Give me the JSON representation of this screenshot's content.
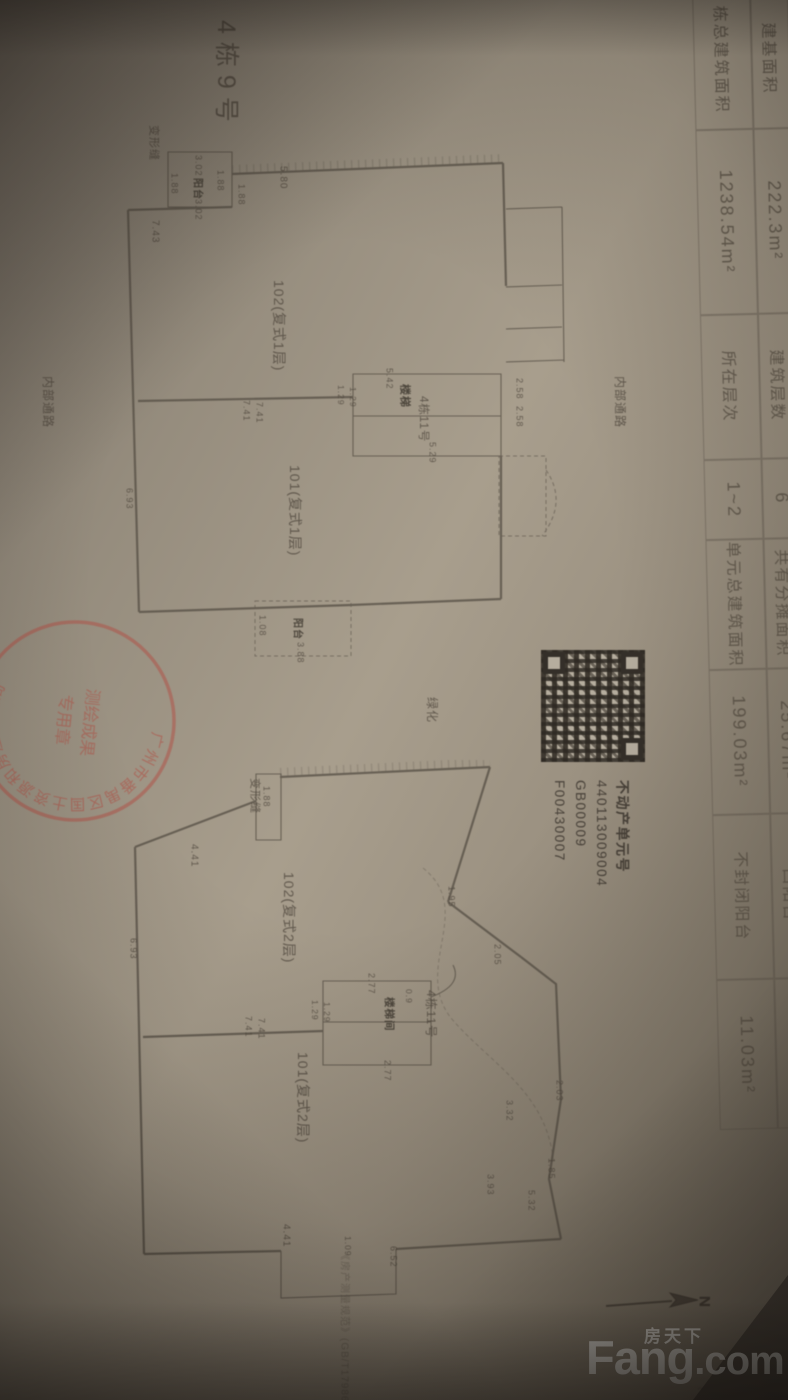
{
  "sheet_title": "4栋9号",
  "table": {
    "r1": [
      {
        "l": "建基面积",
        "v": "222.3m²"
      },
      {
        "l": "建筑层数",
        "v": "6"
      },
      {
        "l": "共有分摊面积",
        "v": "25.67m²"
      },
      {
        "l": "凹阳台",
        "v": "0.00m²"
      }
    ],
    "r2": [
      {
        "l": "栋总建筑面积",
        "v": "1238.54m²"
      },
      {
        "l": "所在层次",
        "v": "1~2"
      },
      {
        "l": "单元总建筑面积",
        "v": "199.03m²"
      },
      {
        "l": "不封闭阳台",
        "v": "11.03m²"
      }
    ]
  },
  "qr": {
    "title": "不动产单元号",
    "lines": [
      "440113009004",
      "GB00009",
      "F00430007"
    ]
  },
  "stamp": {
    "arc_text": "广州市番禺区国土资源和房屋管理局",
    "center_line1": "测绘成果",
    "center_line2": "专用章",
    "color": "#b5463a"
  },
  "north": {
    "label": "N"
  },
  "watermark": {
    "cn": "房天下",
    "en_bold": "Fang",
    "en_rest": ".com"
  },
  "overlay_labels": [
    {
      "t": "4栋9号",
      "x": 211,
      "y": 20,
      "fs": 25,
      "ls": 8,
      "n": "sheet-title-label"
    },
    {
      "t": "变形缝",
      "x": 147,
      "y": 125,
      "fs": 11,
      "n": "expansion-joint-label"
    },
    {
      "t": "内部通路",
      "x": 612,
      "y": 376,
      "fs": 12,
      "n": "internal-road-label"
    },
    {
      "t": "内部通路",
      "x": 40,
      "y": 376,
      "fs": 12,
      "n": "internal-road-label"
    },
    {
      "t": "绿化",
      "x": 424,
      "y": 697,
      "fs": 12,
      "n": "greenery-label"
    },
    {
      "t": "变形缝",
      "x": 248,
      "y": 778,
      "fs": 11,
      "n": "expansion-joint-label"
    },
    {
      "t": "《房产测量规范》(GB/T17986.1-20",
      "x": 338,
      "y": 1250,
      "fs": 10,
      "op": 0.55,
      "n": "note-text"
    },
    {
      "t": "2006.1",
      "x": 697,
      "y": 1386,
      "fs": 11,
      "op": 0.6,
      "hz": 1,
      "n": "date-text"
    },
    {
      "t": "3.02",
      "x": 193,
      "y": 155
    },
    {
      "t": "阳台",
      "x": 191,
      "y": 178,
      "fs": 10,
      "b": 1,
      "n": "room-label"
    },
    {
      "t": "3.02",
      "x": 193,
      "y": 199
    },
    {
      "t": "1.88",
      "x": 169,
      "y": 173
    },
    {
      "t": "1.88",
      "x": 215,
      "y": 170
    },
    {
      "t": "1.88",
      "x": 236,
      "y": 184
    },
    {
      "t": "5.80",
      "x": 277,
      "y": 166,
      "fs": 10
    },
    {
      "t": "7.43",
      "x": 149,
      "y": 220,
      "fs": 10
    },
    {
      "t": "102(复式1层)",
      "x": 271,
      "y": 280,
      "fs": 14,
      "n": "room-label"
    },
    {
      "t": "101(复式1层)",
      "x": 287,
      "y": 465,
      "fs": 14,
      "n": "room-label"
    },
    {
      "t": "7.41",
      "x": 241,
      "y": 400
    },
    {
      "t": "7.41",
      "x": 254,
      "y": 402
    },
    {
      "t": "1.29",
      "x": 335,
      "y": 385,
      "fs": 8.5
    },
    {
      "t": "1.29",
      "x": 347,
      "y": 387,
      "fs": 8.5
    },
    {
      "t": "楼梯",
      "x": 398,
      "y": 384,
      "fs": 11,
      "b": 1,
      "n": "room-label"
    },
    {
      "t": "4栋11号",
      "x": 416,
      "y": 396,
      "fs": 11.5,
      "n": "unit-label"
    },
    {
      "t": "5.42",
      "x": 384,
      "y": 368
    },
    {
      "t": "5.29",
      "x": 427,
      "y": 442
    },
    {
      "t": "2.58",
      "x": 514,
      "y": 378
    },
    {
      "t": "2.58",
      "x": 514,
      "y": 406
    },
    {
      "t": "阳台",
      "x": 291,
      "y": 618,
      "fs": 10,
      "b": 1,
      "n": "room-label"
    },
    {
      "t": "3.88",
      "x": 295,
      "y": 642
    },
    {
      "t": "1.08",
      "x": 257,
      "y": 615
    },
    {
      "t": "6.93",
      "x": 124,
      "y": 488
    },
    {
      "t": "1.88",
      "x": 261,
      "y": 786
    },
    {
      "t": "4.41",
      "x": 188,
      "y": 844,
      "fs": 10
    },
    {
      "t": "102(复式2层)",
      "x": 281,
      "y": 872,
      "fs": 14,
      "n": "room-label"
    },
    {
      "t": "1.95",
      "x": 446,
      "y": 886
    },
    {
      "t": "2.05",
      "x": 492,
      "y": 944
    },
    {
      "t": "6.93",
      "x": 128,
      "y": 938
    },
    {
      "t": "2.77",
      "x": 366,
      "y": 973
    },
    {
      "t": "0.9",
      "x": 403,
      "y": 989,
      "fs": 8.5
    },
    {
      "t": "楼梯间",
      "x": 383,
      "y": 997,
      "fs": 10.5,
      "b": 1,
      "n": "room-label"
    },
    {
      "t": "4栋11号",
      "x": 423,
      "y": 990,
      "fs": 12,
      "n": "unit-label"
    },
    {
      "t": "1.29",
      "x": 309,
      "y": 1000,
      "fs": 8.5
    },
    {
      "t": "1.29",
      "x": 321,
      "y": 1002,
      "fs": 8.5
    },
    {
      "t": "7.41",
      "x": 243,
      "y": 1016
    },
    {
      "t": "7.41",
      "x": 256,
      "y": 1018
    },
    {
      "t": "2.77",
      "x": 382,
      "y": 1060
    },
    {
      "t": "101(复式2层)",
      "x": 295,
      "y": 1052,
      "fs": 14,
      "n": "room-label"
    },
    {
      "t": "2.03",
      "x": 554,
      "y": 1080
    },
    {
      "t": "3.32",
      "x": 504,
      "y": 1100
    },
    {
      "t": "1.85",
      "x": 546,
      "y": 1158
    },
    {
      "t": "3.93",
      "x": 485,
      "y": 1174
    },
    {
      "t": "5.32",
      "x": 526,
      "y": 1190
    },
    {
      "t": "6.52",
      "x": 388,
      "y": 1246
    },
    {
      "t": "4.41",
      "x": 280,
      "y": 1224,
      "fs": 10
    },
    {
      "t": "1.09",
      "x": 342,
      "y": 1236,
      "fs": 8.5
    }
  ]
}
